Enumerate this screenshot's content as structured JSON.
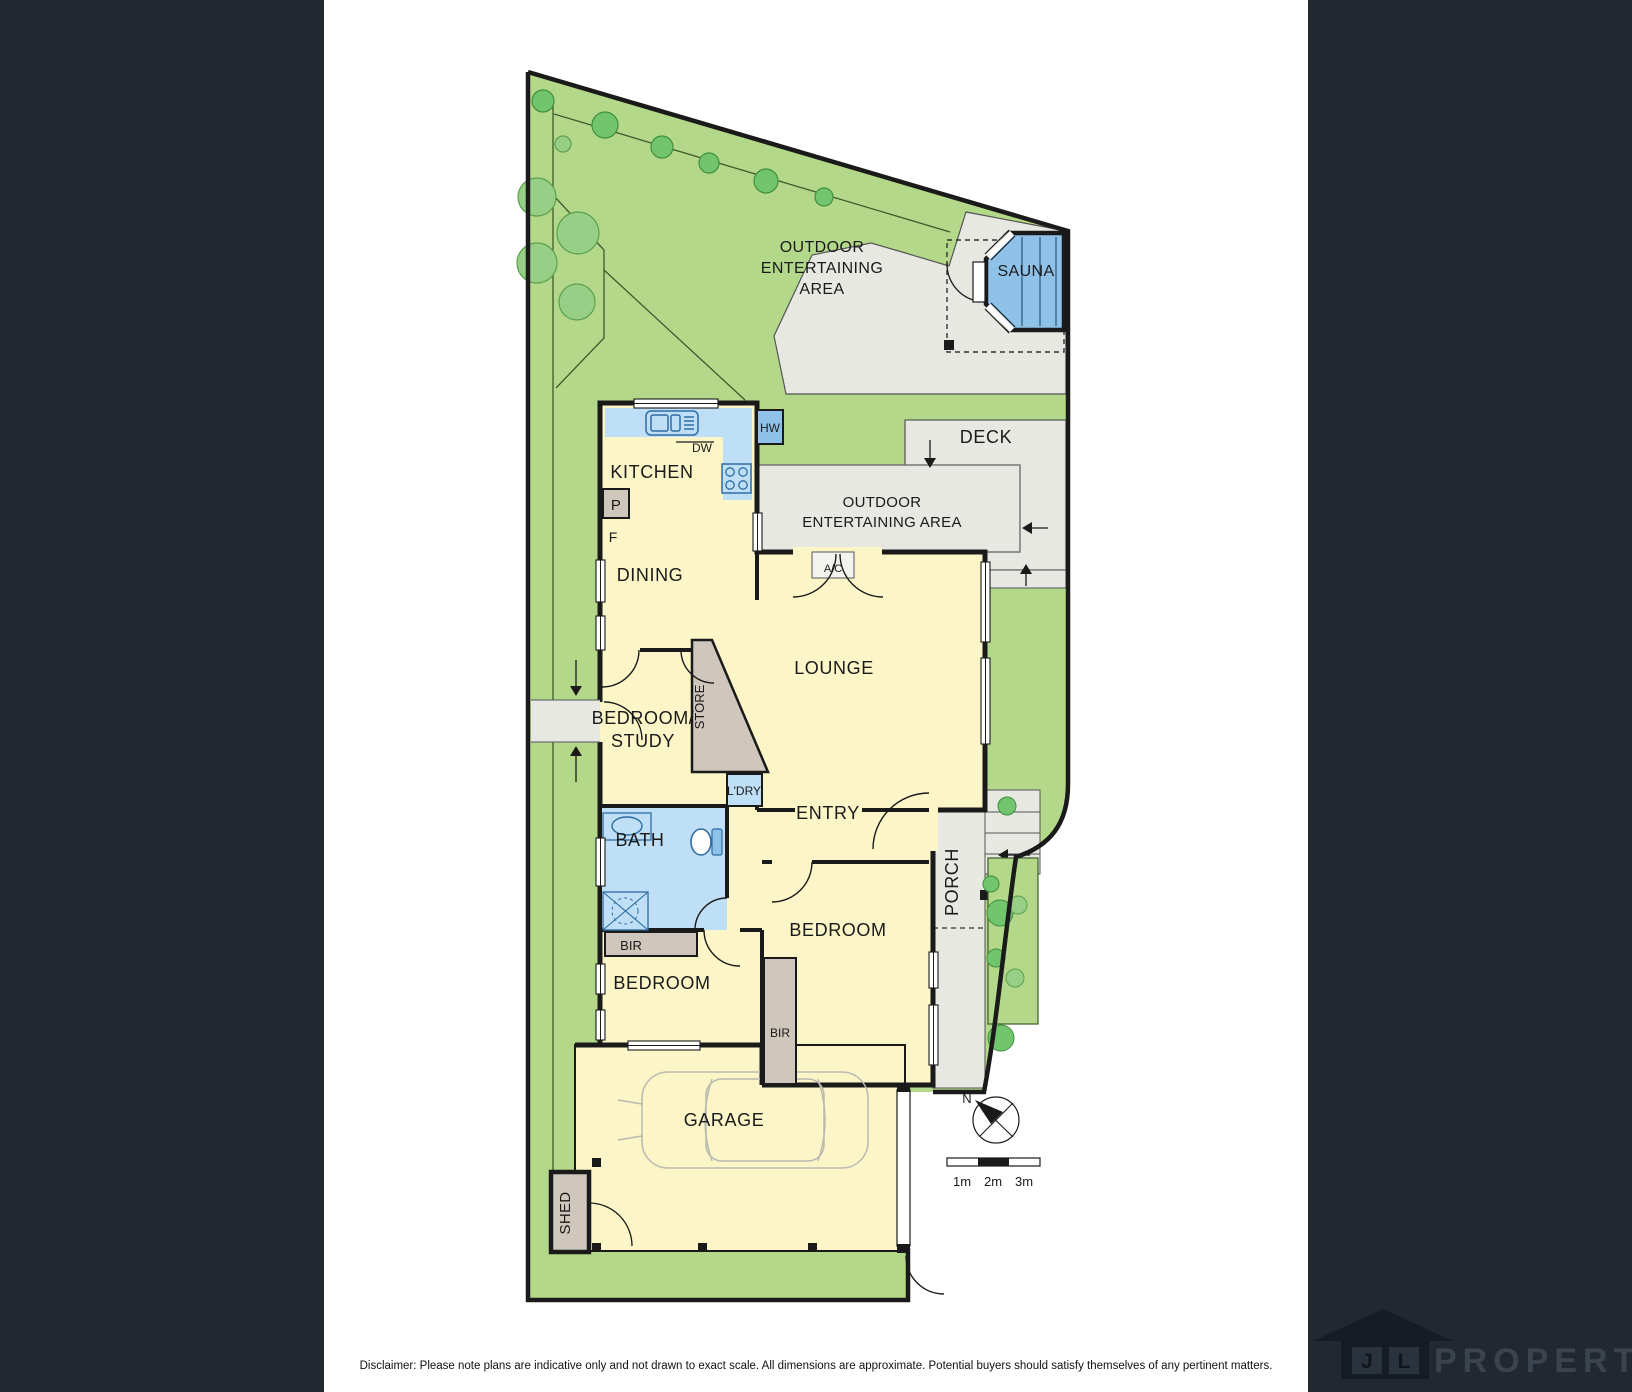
{
  "colors": {
    "sidebar": "#212830",
    "lawn": "#b4d889",
    "room_yellow": "#fbf5c8",
    "wet_blue": "#bedff5",
    "sauna_blue": "#8fc2e9",
    "outdoor_grey": "#e7e8e2",
    "taupe": "#cfc6bc",
    "wall": "#1a1a1a",
    "tree_dark": "#72c46d",
    "tree_light": "#96cf85",
    "brand_dark": "#161c23",
    "brand_text": "#3a434e"
  },
  "labels": {
    "kitchen": "KITCHEN",
    "dining": "DINING",
    "lounge": "LOUNGE",
    "entry": "ENTRY",
    "bath": "BATH",
    "porch": "PORCH",
    "store": "STORE",
    "ldry": "L'DRY",
    "bir_bath": "BIR",
    "bir_beds": "BIR",
    "bedroom_left": "BEDROOM",
    "bedroom_right": "BEDROOM",
    "bedroom_study": [
      "BEDROOM/",
      "STUDY"
    ],
    "garage": "GARAGE",
    "shed": "SHED",
    "sauna": "SAUNA",
    "deck": "DECK",
    "oea_top": [
      "OUTDOOR",
      "ENTERTAINING",
      "AREA"
    ],
    "oea_mid": [
      "OUTDOOR",
      "ENTERTAINING AREA"
    ],
    "dw": "DW",
    "hw": "HW",
    "ac": "A/C",
    "pantry": "P",
    "fridge": "F"
  },
  "compass": {
    "north": "N"
  },
  "scale_bar": {
    "ticks": [
      "1m",
      "2m",
      "3m"
    ]
  },
  "footer": {
    "disclaimer": "Disclaimer: Please note plans are indicative only and not drawn to exact scale. All dimensions are approximate. Potential buyers should satisfy themselves of any pertinent matters."
  },
  "brand": {
    "initial_1": "J",
    "initial_2": "L",
    "name": "PROPERTY"
  }
}
